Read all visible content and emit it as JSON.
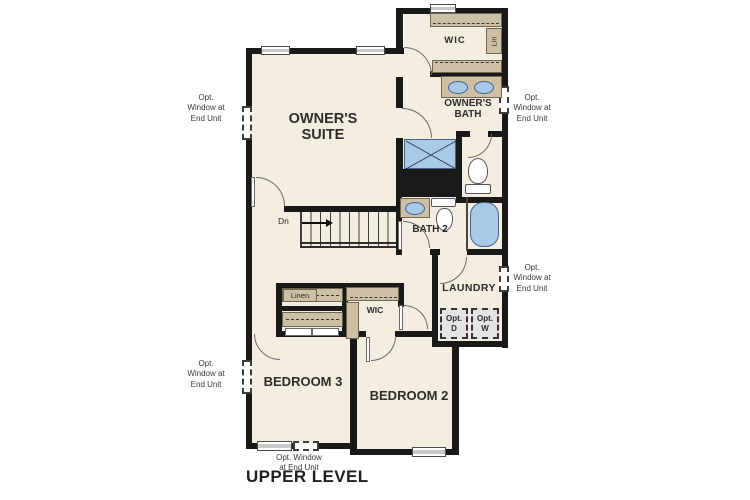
{
  "plan": {
    "title": "UPPER LEVEL",
    "rooms": {
      "owners_suite": "OWNER'S\nSUITE",
      "owners_bath": "OWNER'S\nBATH",
      "wic_owners": "WIC",
      "lin_closet": "Lin",
      "bath2": "BATH 2",
      "laundry": "LAUNDRY",
      "wic_bed2": "WIC",
      "linen": "Linen",
      "bedroom2": "BEDROOM 2",
      "bedroom3": "BEDROOM 3"
    },
    "stairs": {
      "down_label": "Dn"
    },
    "appliances": {
      "opt_dryer": "Opt.\nD",
      "opt_washer": "Opt.\nW"
    },
    "notes": {
      "opt_window_side": "Opt.\nWindow at\nEnd Unit",
      "opt_window_bottom": "Opt. Window\nat End Unit"
    },
    "colors": {
      "floor": "#f4eee1",
      "wall": "#191919",
      "cabinet": "#cdc0a4",
      "fixture_blue": "#a9c9e8",
      "optional_gray": "#e4e4e4"
    }
  }
}
